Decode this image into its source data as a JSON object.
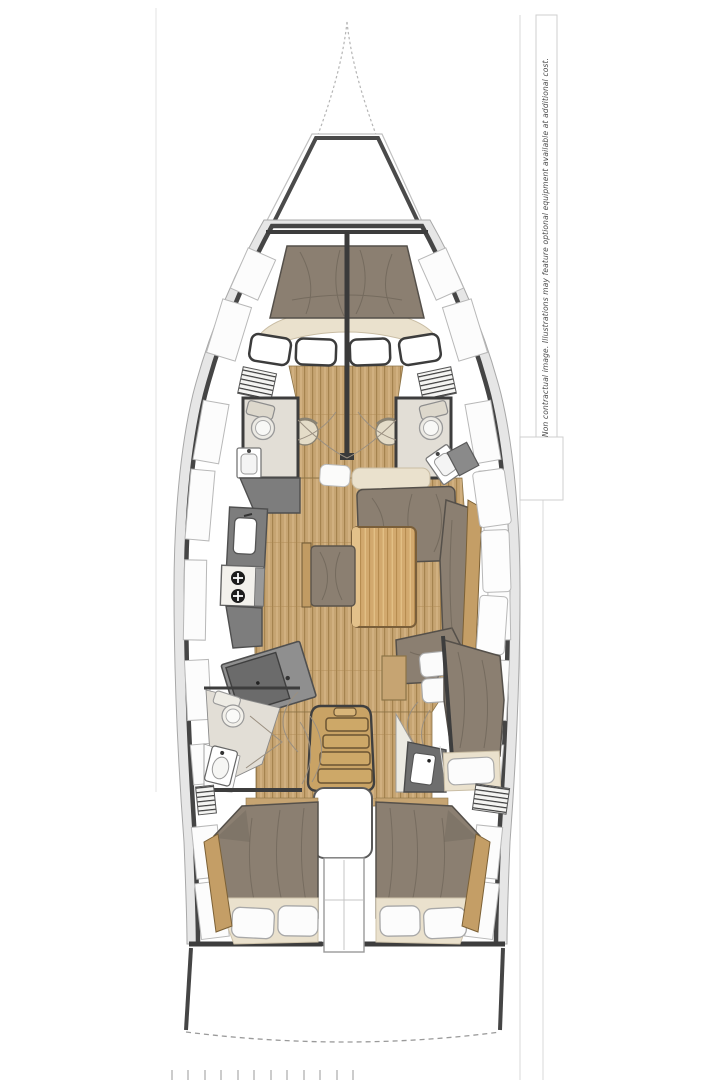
{
  "sheet": {
    "disclaimer_text": "Non contractual image. Illustrations may feature optional equipment available at additional cost."
  },
  "plan": {
    "type": "sailboat-interior-deck-plan",
    "orientation": "bow-up",
    "colors": {
      "hull_outline": "#454545",
      "hull_band": "#e6e6e6",
      "wood_floor": "#c6a472",
      "wood_floor_line": "#a5834f",
      "wood_trim": "#c49e66",
      "table_wood": "#d2a96e",
      "upholstery_taupe": "#8b7f71",
      "upholstery_crease": "#6e6458",
      "cushion_cream": "#eae1cd",
      "pillow_white": "#fbfbfb",
      "counter_gray": "#7d7d7d",
      "counter_dark": "#6b6b6b",
      "head_floor": "#e2ded6",
      "fixture_white": "#ffffff",
      "sheet_line": "#d8d8d8"
    },
    "legend": [
      {
        "name": "bowsprit",
        "kind": "hull-structure"
      },
      {
        "name": "anchor-locker",
        "kind": "compartment"
      },
      {
        "name": "v-berth",
        "kind": "double-berth"
      },
      {
        "name": "deck-hatch",
        "kind": "window"
      },
      {
        "name": "louver-vent",
        "kind": "vent"
      },
      {
        "name": "vanity-stool",
        "kind": "seat"
      },
      {
        "name": "toilet",
        "kind": "head-fixture"
      },
      {
        "name": "washbasin",
        "kind": "head-fixture"
      },
      {
        "name": "galley-sink",
        "kind": "galley-fixture"
      },
      {
        "name": "stove",
        "kind": "galley-fixture"
      },
      {
        "name": "chart-table",
        "kind": "nav-station"
      },
      {
        "name": "salon-table",
        "kind": "table"
      },
      {
        "name": "bench-seat",
        "kind": "seat"
      },
      {
        "name": "settee",
        "kind": "seat"
      },
      {
        "name": "companionway-steps",
        "kind": "stairs"
      },
      {
        "name": "engine-compartment",
        "kind": "compartment"
      },
      {
        "name": "aft-double-berth",
        "kind": "double-berth"
      },
      {
        "name": "pillow",
        "kind": "bedding"
      },
      {
        "name": "wood-floor",
        "kind": "floor"
      },
      {
        "name": "transom",
        "kind": "hull-structure"
      }
    ]
  }
}
